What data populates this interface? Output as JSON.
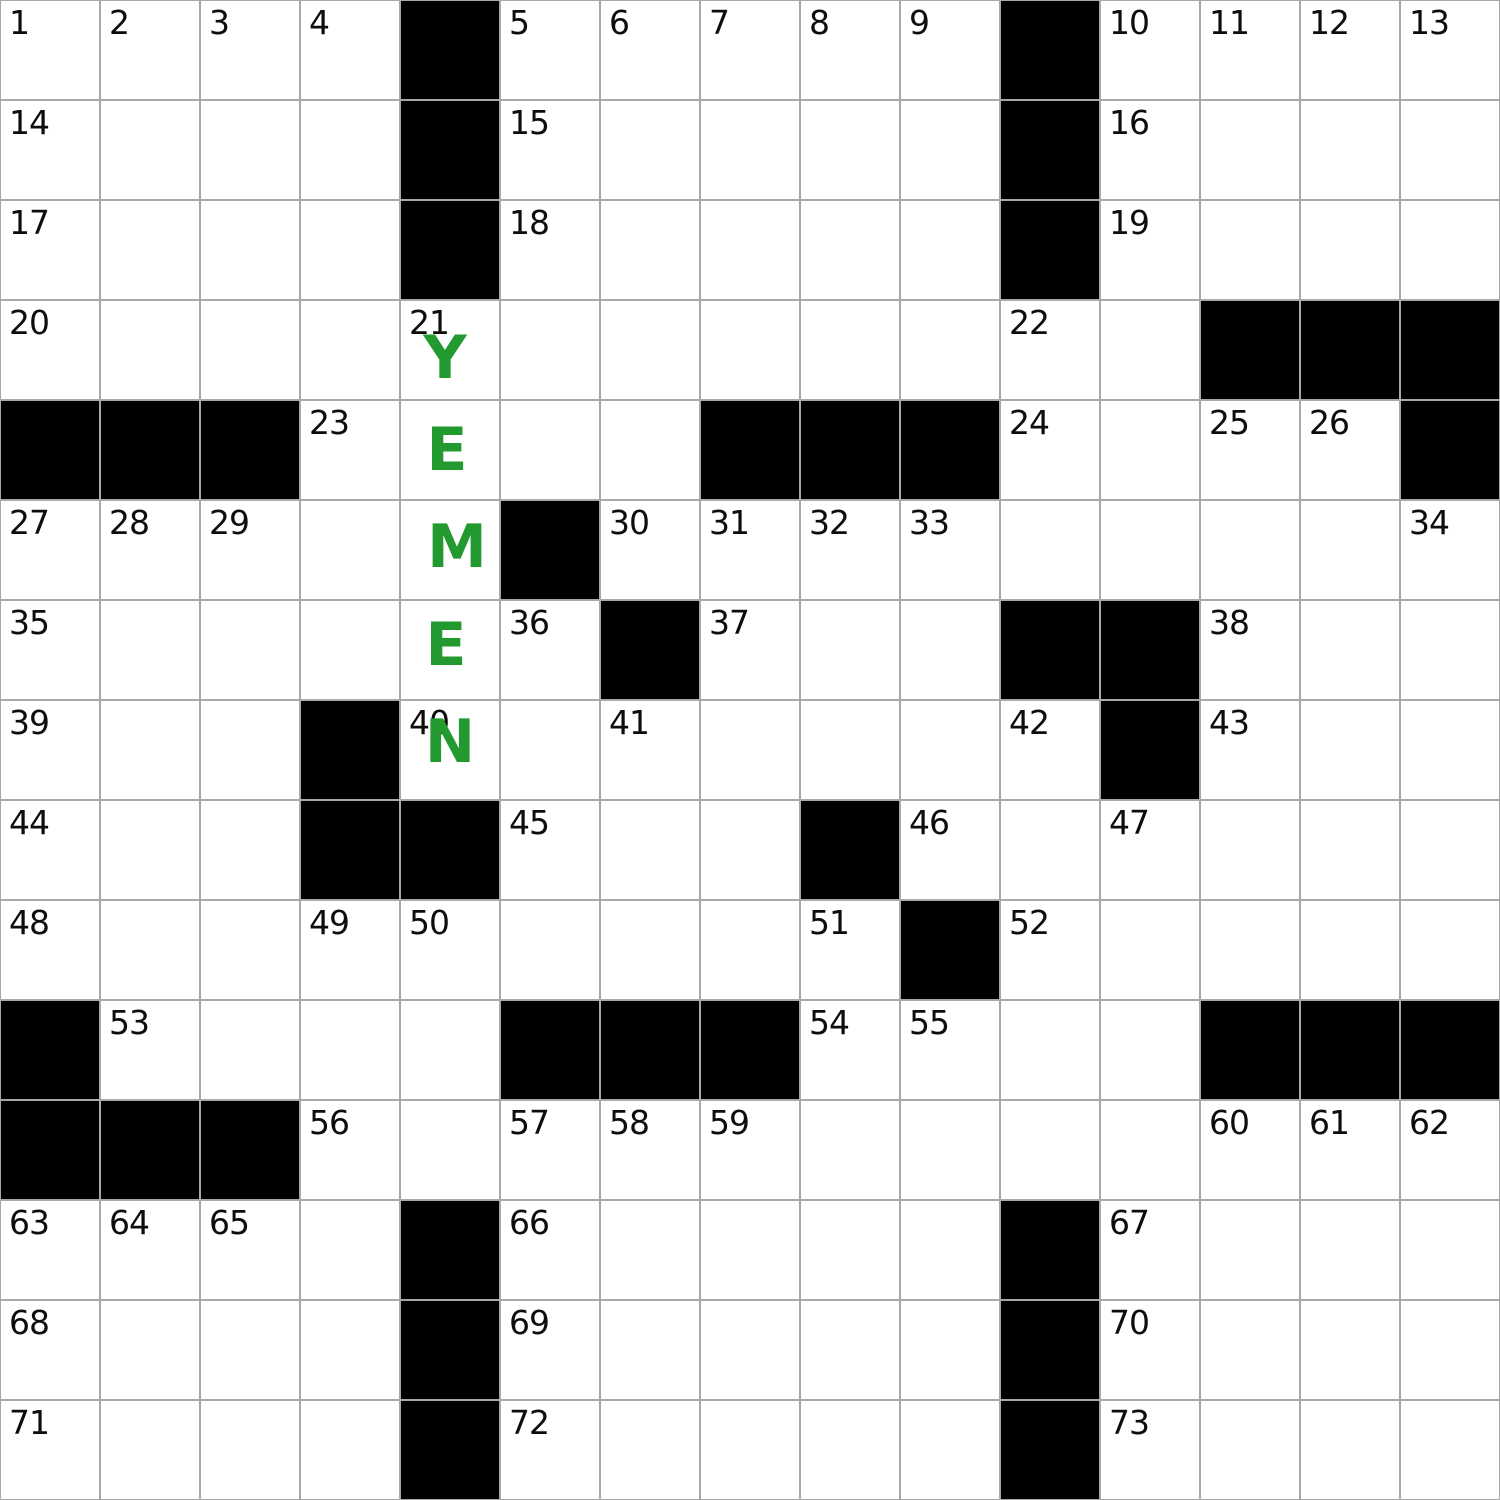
{
  "puzzle": {
    "kind": "crossword-grid",
    "rows": 15,
    "cols": 15,
    "cell_size_px": 100,
    "colors": {
      "black_cell": "#000000",
      "white_cell": "#ffffff",
      "grid_line": "#a8a8a8",
      "number_color": "#0d0d0d",
      "answer_green": "#229a30"
    },
    "black_cells_rc": [
      [
        0,
        4
      ],
      [
        0,
        10
      ],
      [
        1,
        4
      ],
      [
        1,
        10
      ],
      [
        2,
        4
      ],
      [
        2,
        10
      ],
      [
        3,
        12
      ],
      [
        3,
        13
      ],
      [
        3,
        14
      ],
      [
        4,
        0
      ],
      [
        4,
        1
      ],
      [
        4,
        2
      ],
      [
        4,
        7
      ],
      [
        4,
        8
      ],
      [
        4,
        9
      ],
      [
        4,
        14
      ],
      [
        5,
        5
      ],
      [
        6,
        6
      ],
      [
        6,
        10
      ],
      [
        6,
        11
      ],
      [
        7,
        3
      ],
      [
        7,
        11
      ],
      [
        8,
        3
      ],
      [
        8,
        4
      ],
      [
        8,
        8
      ],
      [
        9,
        9
      ],
      [
        10,
        0
      ],
      [
        10,
        5
      ],
      [
        10,
        6
      ],
      [
        10,
        7
      ],
      [
        10,
        12
      ],
      [
        10,
        13
      ],
      [
        10,
        14
      ],
      [
        11,
        0
      ],
      [
        11,
        1
      ],
      [
        11,
        2
      ],
      [
        12,
        4
      ],
      [
        12,
        10
      ],
      [
        13,
        4
      ],
      [
        13,
        10
      ],
      [
        14,
        4
      ],
      [
        14,
        10
      ]
    ],
    "numbers_format": "[clue_number, row, col]",
    "numbers": [
      [
        "1",
        0,
        0
      ],
      [
        "2",
        0,
        1
      ],
      [
        "3",
        0,
        2
      ],
      [
        "4",
        0,
        3
      ],
      [
        "5",
        0,
        5
      ],
      [
        "6",
        0,
        6
      ],
      [
        "7",
        0,
        7
      ],
      [
        "8",
        0,
        8
      ],
      [
        "9",
        0,
        9
      ],
      [
        "10",
        0,
        11
      ],
      [
        "11",
        0,
        12
      ],
      [
        "12",
        0,
        13
      ],
      [
        "13",
        0,
        14
      ],
      [
        "14",
        1,
        0
      ],
      [
        "15",
        1,
        5
      ],
      [
        "16",
        1,
        11
      ],
      [
        "17",
        2,
        0
      ],
      [
        "18",
        2,
        5
      ],
      [
        "19",
        2,
        11
      ],
      [
        "20",
        3,
        0
      ],
      [
        "21",
        3,
        4
      ],
      [
        "22",
        3,
        10
      ],
      [
        "23",
        4,
        3
      ],
      [
        "24",
        4,
        10
      ],
      [
        "25",
        4,
        12
      ],
      [
        "26",
        4,
        13
      ],
      [
        "27",
        5,
        0
      ],
      [
        "28",
        5,
        1
      ],
      [
        "29",
        5,
        2
      ],
      [
        "30",
        5,
        6
      ],
      [
        "31",
        5,
        7
      ],
      [
        "32",
        5,
        8
      ],
      [
        "33",
        5,
        9
      ],
      [
        "34",
        5,
        14
      ],
      [
        "35",
        6,
        0
      ],
      [
        "36",
        6,
        5
      ],
      [
        "37",
        6,
        7
      ],
      [
        "38",
        6,
        12
      ],
      [
        "39",
        7,
        0
      ],
      [
        "40",
        7,
        4
      ],
      [
        "41",
        7,
        6
      ],
      [
        "42",
        7,
        10
      ],
      [
        "43",
        7,
        12
      ],
      [
        "44",
        8,
        0
      ],
      [
        "45",
        8,
        5
      ],
      [
        "46",
        8,
        9
      ],
      [
        "47",
        8,
        11
      ],
      [
        "48",
        9,
        0
      ],
      [
        "49",
        9,
        3
      ],
      [
        "50",
        9,
        4
      ],
      [
        "51",
        9,
        8
      ],
      [
        "52",
        9,
        10
      ],
      [
        "53",
        10,
        1
      ],
      [
        "54",
        10,
        8
      ],
      [
        "55",
        10,
        9
      ],
      [
        "56",
        11,
        3
      ],
      [
        "57",
        11,
        5
      ],
      [
        "58",
        11,
        6
      ],
      [
        "59",
        11,
        7
      ],
      [
        "60",
        11,
        12
      ],
      [
        "61",
        11,
        13
      ],
      [
        "62",
        11,
        14
      ],
      [
        "63",
        12,
        0
      ],
      [
        "64",
        12,
        1
      ],
      [
        "65",
        12,
        2
      ],
      [
        "66",
        12,
        5
      ],
      [
        "67",
        12,
        11
      ],
      [
        "68",
        13,
        0
      ],
      [
        "69",
        13,
        5
      ],
      [
        "70",
        13,
        11
      ],
      [
        "71",
        14,
        0
      ],
      [
        "72",
        14,
        5
      ],
      [
        "73",
        14,
        11
      ]
    ],
    "filled_answer": {
      "word": "YEMEN",
      "direction": "down",
      "start_clue_number": "21",
      "letters": [
        {
          "letter": "Y",
          "row": 3,
          "col": 4,
          "dx": -5,
          "dy": 8
        },
        {
          "letter": "E",
          "row": 4,
          "col": 4,
          "dx": -3,
          "dy": 0
        },
        {
          "letter": "M",
          "row": 5,
          "col": 4,
          "dx": 7,
          "dy": -3
        },
        {
          "letter": "E",
          "row": 6,
          "col": 4,
          "dx": -4,
          "dy": -5
        },
        {
          "letter": "N",
          "row": 7,
          "col": 4,
          "dx": 0,
          "dy": -8
        }
      ]
    }
  }
}
